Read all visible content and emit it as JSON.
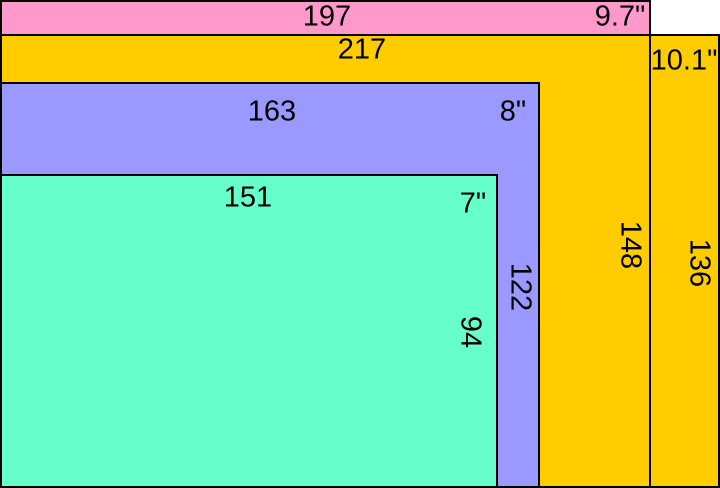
{
  "figure": {
    "kind": "screen-size-comparison",
    "background": "#FFFFFF",
    "outline_color": "#000000"
  },
  "rects": [
    {
      "name": "9.7 inch screen",
      "diagonal_label": "9.7\"",
      "width_label": "197",
      "height_label": "148",
      "color": "#FF99CC",
      "width": 197,
      "height": 148
    },
    {
      "name": "10.1 inch screen",
      "diagonal_label": "10.1\"",
      "width_label": "217",
      "height_label": "136",
      "color": "#FFCC00",
      "width": 217,
      "height": 136
    },
    {
      "name": "8 inch screen",
      "diagonal_label": "8\"",
      "width_label": "163",
      "height_label": "122",
      "color": "#9999FF",
      "width": 163,
      "height": 122
    },
    {
      "name": "7 inch screen",
      "diagonal_label": "7\"",
      "width_label": "151",
      "height_label": "94",
      "color": "#66FFCC",
      "width": 151,
      "height": 94
    }
  ]
}
